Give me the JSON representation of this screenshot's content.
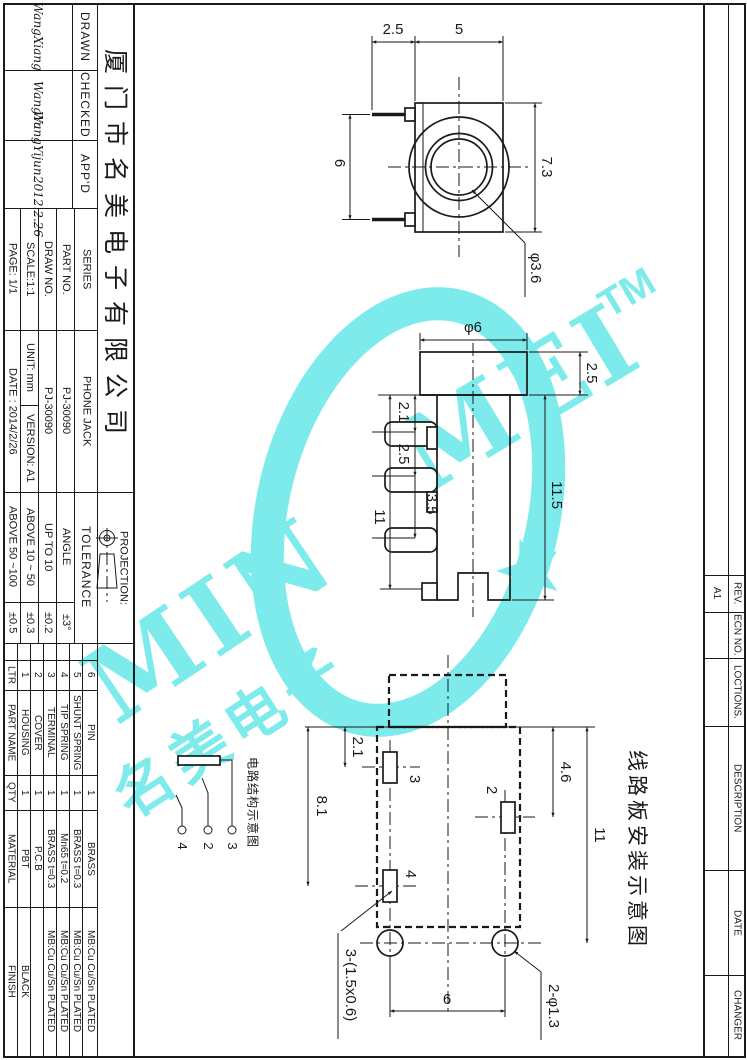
{
  "watermark": {
    "word_left": "MIN",
    "word_right": "MEI",
    "tm": "TM",
    "cjk": "名美电子",
    "color": "#7DEBEB"
  },
  "title_block": {
    "company": "厦门市名美电子有限公司",
    "staff": {
      "drawn_label": "DRAWN",
      "drawn_sig": "WangXiang",
      "checked_label": "CHECKED",
      "checked_sig": "WangYu",
      "appd_label": "APP'D",
      "appd_sig": "WangYijun",
      "appd_date": "2012.2.26"
    },
    "fields": {
      "page": "PAGE: 1/1",
      "date": "DATE : 2014/2/26",
      "scale": "SCALE:1:1",
      "unit": "UNIT: mm",
      "version": "VERSION: A1",
      "draw_no_label": "DRAW NO.",
      "draw_no": "PJ-30090",
      "part_no_label": "PART NO.",
      "part_no": "PJ-30090",
      "series_label": "SERIES",
      "series": "PHONE JACK"
    },
    "projection_label": "PROJECTION:",
    "tolerance": {
      "label": "TOLERANCE",
      "rows": [
        {
          "range": "ABOVE 50 ~100",
          "value": "±0.5"
        },
        {
          "range": "ABOVE 10 ~ 50",
          "value": "±0.3"
        },
        {
          "range": "UP TO 10",
          "value": "±0.2"
        },
        {
          "range": "ANGLE",
          "value": "±3°"
        }
      ]
    }
  },
  "parts_table": {
    "headers": {
      "ltr": "LTR",
      "part_name": "PART NAME",
      "qty": "QTY",
      "material": "MATERIAL",
      "finish": "FINISH"
    },
    "rows": [
      {
        "ltr": "1",
        "name": "HOUSING",
        "qty": "1",
        "material": "PBT",
        "finish": "BLACK"
      },
      {
        "ltr": "2",
        "name": "COVER",
        "qty": "1",
        "material": "P.C.B",
        "finish": ""
      },
      {
        "ltr": "3",
        "name": "TERMINAL",
        "qty": "1",
        "material": "BRASS t=0.3",
        "finish": "MB:Cu Cu/Sn PLATED"
      },
      {
        "ltr": "4",
        "name": "TIP SPRING",
        "qty": "1",
        "material": "Mn65 t=0.2",
        "finish": "MB:Cu Cu/Sn PLATED"
      },
      {
        "ltr": "5",
        "name": "SHUNT SPRING",
        "qty": "1",
        "material": "BRASS t=0.3",
        "finish": "MB:Cu Cu/Sn PLATED"
      },
      {
        "ltr": "6",
        "name": "PIN",
        "qty": "1",
        "material": "BRASS",
        "finish": "MB:Cu Cu/Sn PLATED"
      }
    ]
  },
  "revision": {
    "rev_label": "REV.",
    "rev_value": "A1",
    "ecn_label": "ECN NO.",
    "loctions_label": "LOCTIONS.",
    "description_label": "DESCRIPTION",
    "date_label": "DATE",
    "changer_label": "CHANGER"
  },
  "views": {
    "front": {
      "dim_25": "2.5",
      "dim_5": "5",
      "dim_6": "6",
      "dim_73": "7.3",
      "dim_hole": "φ3.6"
    },
    "side": {
      "dim_d6": "φ6",
      "dim_25": "2.5",
      "dim_21": "2.1",
      "dim_25b": "2.5",
      "dim_35": "3.5",
      "dim_11": "11",
      "dim_115": "11.5"
    },
    "pcb": {
      "caption": "线路板安装示意图",
      "dim_21": "2.1",
      "dim_81": "8.1",
      "dim_46": "4.6",
      "dim_11": "11",
      "dim_6": "6",
      "slot_note": "3-(1.5x0.6)",
      "hole_note": "2-φ1.3",
      "pin3": "3",
      "pin2": "2",
      "pin4": "4"
    },
    "circuit": {
      "caption": "电路结构示意图",
      "pin4": "4",
      "pin2": "2",
      "pin3": "3"
    }
  }
}
